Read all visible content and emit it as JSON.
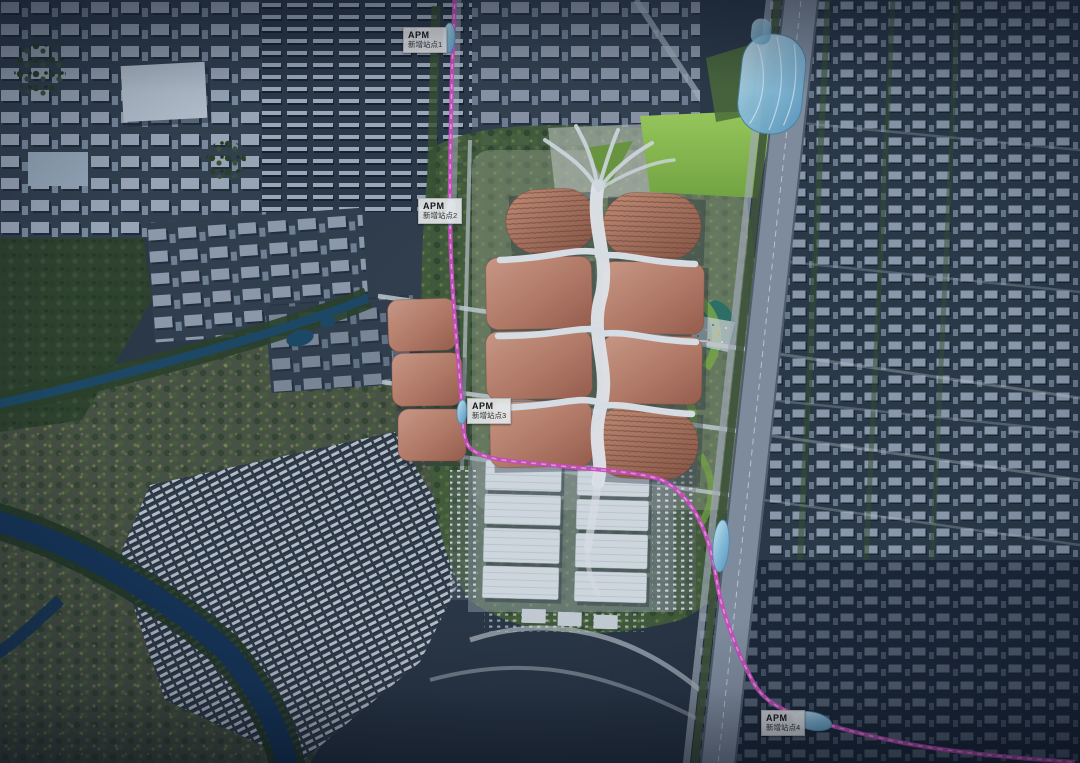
{
  "scene": {
    "type": "aerial-masterplan-render",
    "transit_system": "APM"
  },
  "apm_labels": [
    {
      "title": "APM",
      "subtitle": "新增站点1"
    },
    {
      "title": "APM",
      "subtitle": "新增站点2"
    },
    {
      "title": "APM",
      "subtitle": "新增站点3"
    },
    {
      "title": "APM",
      "subtitle": "新增站点4"
    }
  ],
  "markers": {
    "station_marker": "blue-glass-oval-station-marker",
    "line_marker": "magenta-apm-line"
  },
  "colors": {
    "apm_line": "#d44fc4",
    "apm_line_dash": "#f2a6e4",
    "station_fill": "#8fd4f0",
    "hall_roof": "#c68974",
    "hall_roof_dark": "#9c604e",
    "spine_white": "#eef1f4",
    "river": "#16365a",
    "canal": "#1d4a66",
    "lawn": "#8fc653",
    "label_bg": "#f5f5f4",
    "city_base": "#2c3947",
    "corridor": "#8793a3"
  }
}
